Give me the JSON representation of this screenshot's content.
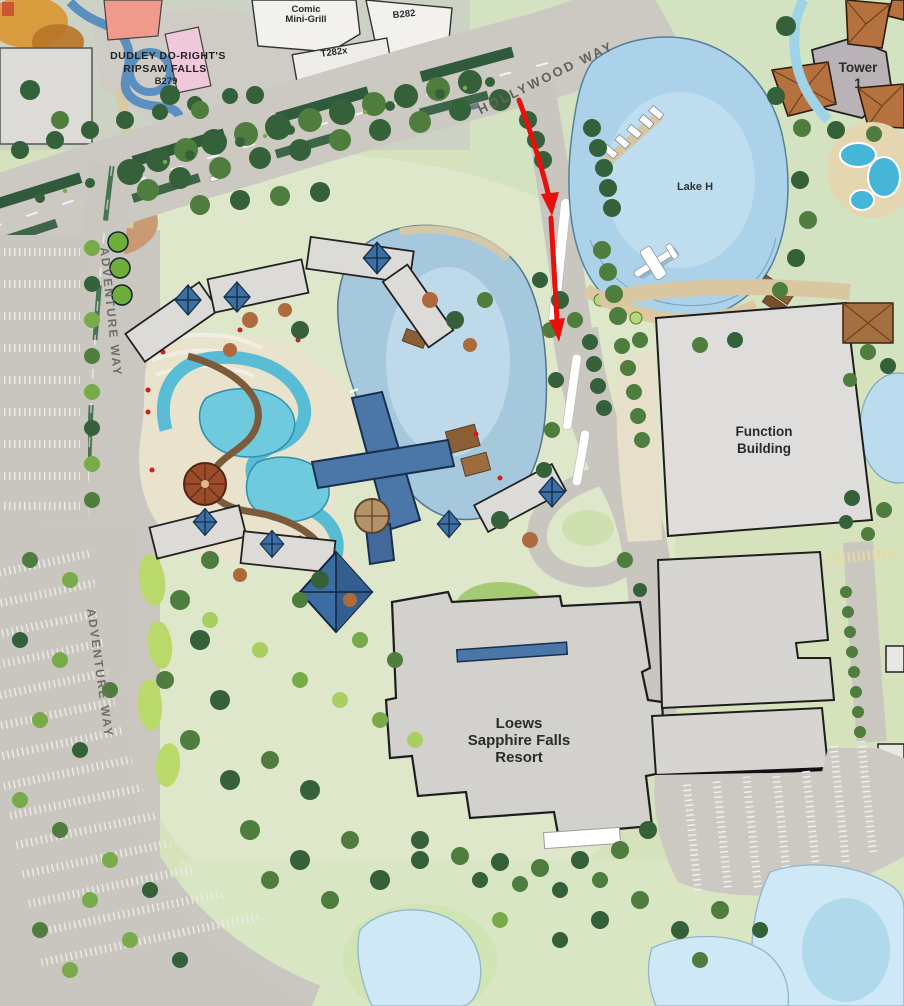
{
  "map": {
    "title": "Resort site plan map with arrival route",
    "labels": {
      "dudley1": "DUDLEY DO-RIGHT'S",
      "dudley2": "RIPSAW FALLS",
      "dudley3": "B279",
      "comic1": "Comic",
      "comic2": "Mini-Grill",
      "b282": "B282",
      "t282x": "T282x",
      "hollywood_way": "HOLLYWOOD WAY",
      "adventure_way_north": "ADVENTURE WAY",
      "adventure_way_south": "ADVENTURE WAY",
      "tower1_line1": "Tower",
      "tower1_line2": "1",
      "lake": "Lake H",
      "function1": "Function",
      "function2": "Building",
      "resort1": "Loews",
      "resort2": "Sapphire Falls",
      "resort3": "Resort"
    },
    "icons": {
      "seaplane_icon": "✈",
      "palm_icon": "✳",
      "route_arrow_icon": "↓"
    },
    "colors": {
      "route_red": "#e8100c",
      "lake_blue": "#abd2e8",
      "pool_teal": "#6fcadd",
      "roof_blue": "#3e6fa3",
      "roof_orange": "#b5723f",
      "building_gray": "#d6d5d1",
      "road_gray": "#cbc8c2",
      "lawn_green": "#d5e2bc",
      "tree_dark": "#35613a",
      "median_island_white": "#ffffff"
    }
  }
}
